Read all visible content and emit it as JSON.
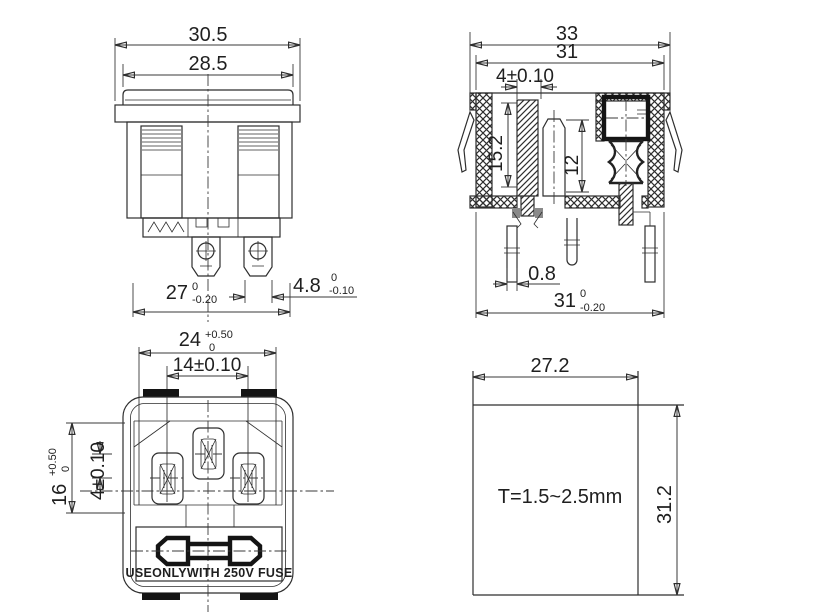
{
  "front_view": {
    "w_outer": "30.5",
    "w_cap": "28.5",
    "w_body": "27",
    "w_body_tol_u": "0",
    "w_body_tol_d": "-0.20",
    "tab_w": "4.8",
    "tab_w_tol_u": "0",
    "tab_w_tol_d": "-0.10"
  },
  "side_view": {
    "w_outer": "33",
    "w_flange": "31",
    "pin_w": "4±0.10",
    "cavity_d": "15.2",
    "pin_len": "12",
    "pin_t": "0.8",
    "w_bottom": "31",
    "w_bottom_tol_u": "0",
    "w_bottom_tol_d": "-0.20"
  },
  "panel_view": {
    "open_w": "24",
    "open_w_tol_u": "+0.50",
    "open_w_tol_d": "0",
    "pin_pitch": "14±0.10",
    "open_h": "16",
    "open_h_tol_u": "+0.50",
    "open_h_tol_d": "0",
    "pin_offset": "4±0.10",
    "fuse_label": "USEONLYWITH 250V FUSE"
  },
  "cutout_view": {
    "w": "27.2",
    "h": "31.2",
    "thickness_note": "T=1.5~2.5mm"
  }
}
